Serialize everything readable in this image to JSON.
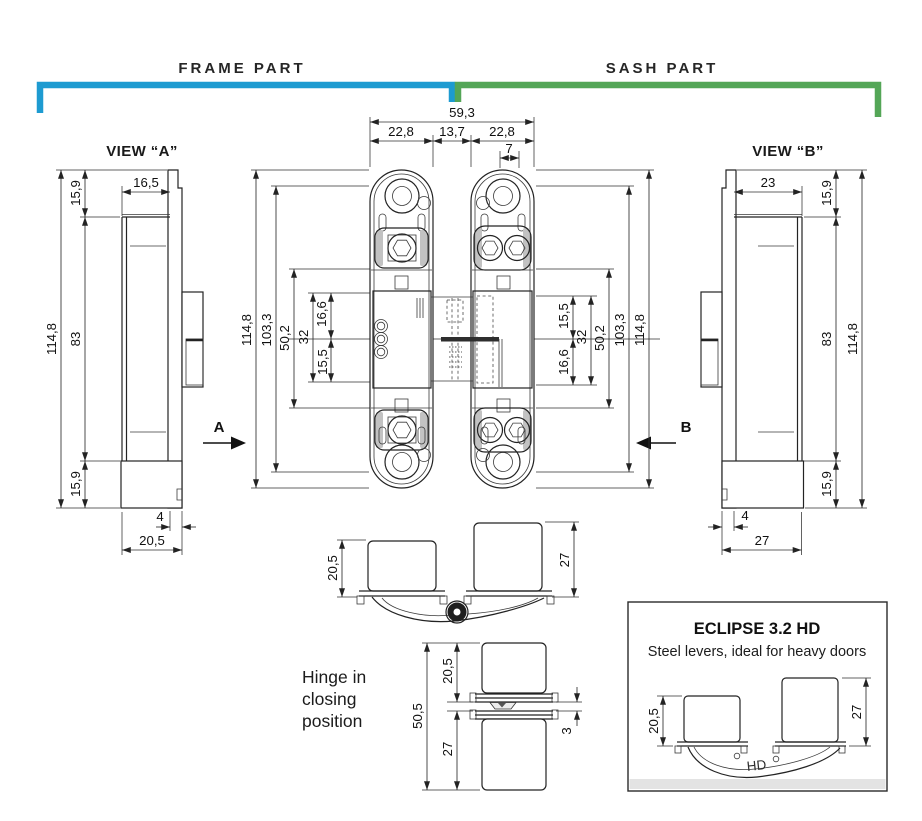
{
  "colors": {
    "frame_bracket": "#1d9bd1",
    "sash_bracket": "#54a657",
    "line": "#232323"
  },
  "header": {
    "frame_part": "FRAME PART",
    "sash_part": "SASH PART"
  },
  "view_a": {
    "title": "VIEW “A”",
    "arrow_label": "A",
    "dims": {
      "total_height": "114,8",
      "top": "15,9",
      "face_depth": "16,5",
      "middle": "83",
      "bottom": "15,9",
      "lip": "4",
      "depth": "20,5"
    }
  },
  "view_b": {
    "title": "VIEW “B”",
    "arrow_label": "B",
    "dims": {
      "face_depth": "23",
      "top": "15,9",
      "middle": "83",
      "total_height": "114,8",
      "bottom": "15,9",
      "lip": "4",
      "depth": "27"
    }
  },
  "front_view": {
    "top_dims": {
      "total_width": "59,3",
      "frame_width": "22,8",
      "center": "13,7",
      "sash_width": "22,8",
      "slot": "7"
    },
    "frame_dims": {
      "total_height": "114,8",
      "screw_span": "103,3",
      "lever_span": "50,2",
      "center_span": "32",
      "above_axis": "16,6",
      "below_axis": "15,5"
    },
    "sash_dims": {
      "above_axis": "15,5",
      "center_span": "32",
      "below_axis": "16,6",
      "lever_span": "50,2",
      "screw_span": "103,3",
      "total_height": "114,8"
    }
  },
  "open_view": {
    "dims": {
      "frame_cup": "20,5",
      "sash_cup": "27"
    }
  },
  "closed_view": {
    "caption": "Hinge in closing position",
    "dims": {
      "upper_cup": "20,5",
      "total": "50,5",
      "lower_cup": "27",
      "gap": "3"
    }
  },
  "info_box": {
    "title": "ECLIPSE 3.2 HD",
    "subtitle": "Steel levers, ideal for heavy doors",
    "lever_label": "HD",
    "dims": {
      "left_cup": "20,5",
      "right_cup": "27"
    }
  }
}
